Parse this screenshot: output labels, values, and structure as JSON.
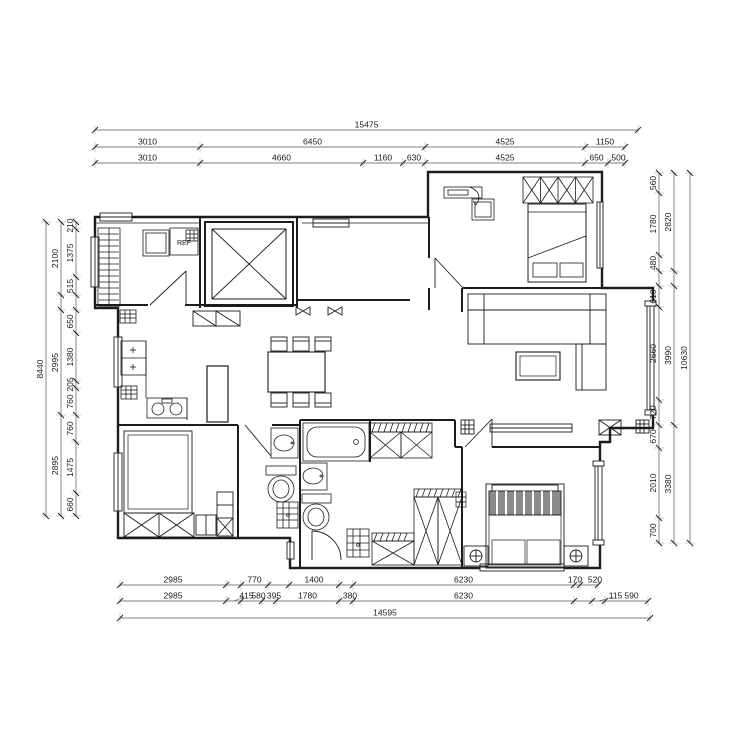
{
  "plan": {
    "labels": {
      "fridge": "REF"
    }
  },
  "dimensions": {
    "top_total": [
      "15475"
    ],
    "top_row2": [
      "3010",
      "6450",
      "4525",
      "1150"
    ],
    "top_row3": [
      "3010",
      "4660",
      "1160",
      "630",
      "4525",
      "650",
      "500"
    ],
    "left_total": [
      "8440"
    ],
    "left_mid": [
      "2100",
      "2995",
      "2895"
    ],
    "left_inner": [
      "210",
      "1375",
      "515",
      "650",
      "1380",
      "205",
      "760",
      "760",
      "1475",
      "660"
    ],
    "right_total": [
      "10630"
    ],
    "right_mid": [
      "2820",
      "3990",
      "3380"
    ],
    "right_inner": [
      "560",
      "1780",
      "480",
      "610",
      "2660",
      "720",
      "670",
      "2010",
      "700"
    ],
    "bottom_total": [
      "14595"
    ],
    "bottom_row1": [
      "2985",
      "770",
      "1400",
      "6230",
      "170",
      "520"
    ],
    "bottom_row2": [
      "2985",
      "415",
      "580",
      "395",
      "1780",
      "380",
      "6230",
      "115",
      "590"
    ]
  }
}
